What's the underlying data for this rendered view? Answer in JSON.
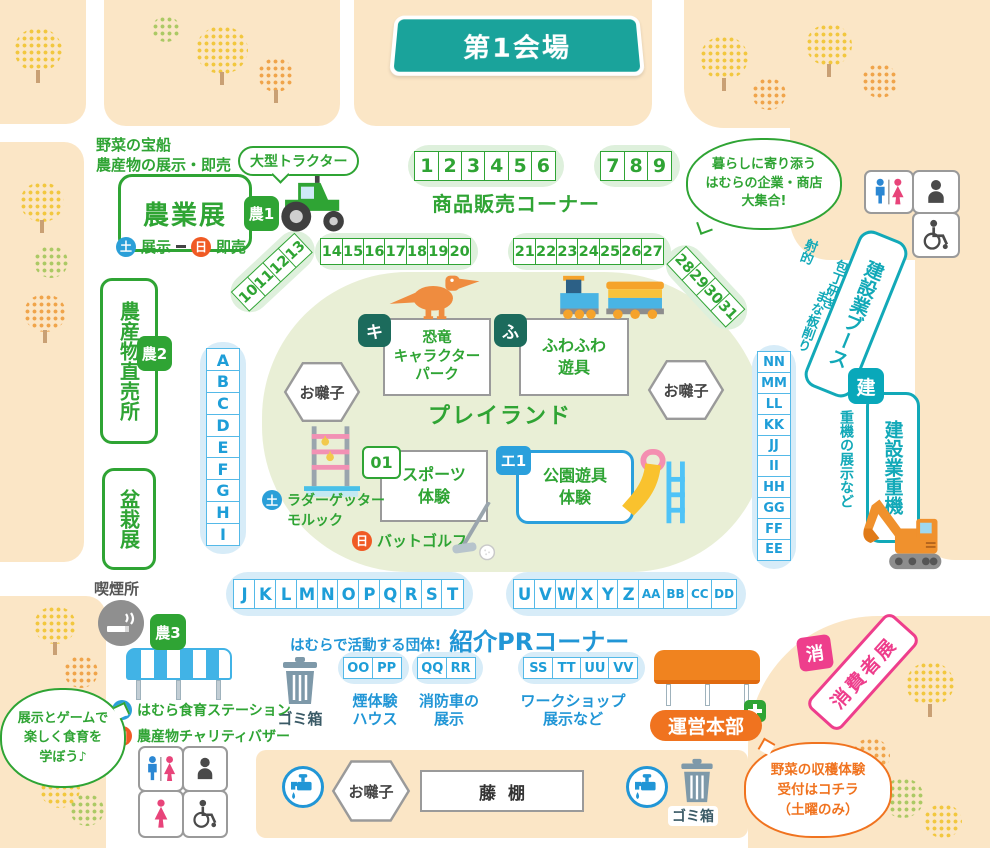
{
  "title": "第1会場",
  "agri": {
    "note_lines": [
      "野菜の宝船",
      "農産物の展示・即売"
    ],
    "bubble": "大型トラクター",
    "name": "農業展",
    "badge": "農1",
    "sat": "土",
    "sat_label": "展示",
    "sun": "日",
    "sun_label": "即売"
  },
  "sales": {
    "numbers1": [
      "1",
      "2",
      "3",
      "4",
      "5",
      "6"
    ],
    "numbers2": [
      "7",
      "8",
      "9"
    ],
    "label": "商品販売コーナー",
    "diag1": [
      "10",
      "11",
      "12",
      "13"
    ],
    "row1": [
      "14",
      "15",
      "16",
      "17",
      "18",
      "19",
      "20"
    ],
    "row2": [
      "21",
      "22",
      "23",
      "24",
      "25",
      "26",
      "27"
    ],
    "diag2": [
      "28",
      "29",
      "30",
      "31"
    ]
  },
  "bubble_companies": {
    "lines": [
      "暮らしに寄り添う",
      "はむらの企業・商店",
      "大集合!"
    ]
  },
  "left": {
    "farm_stand": "農産物直売所",
    "badge": "農2",
    "bonsai": "盆栽展",
    "letters": [
      "A",
      "B",
      "C",
      "D",
      "E",
      "F",
      "G",
      "H",
      "I"
    ],
    "smoking": "喫煙所"
  },
  "playland": {
    "label": "プレイランド",
    "ohayashi": "お囃子",
    "dino_badge": "キ",
    "dino_lines": [
      "恐竜",
      "キャラクター",
      "パーク"
    ],
    "fuwa_badge": "ふ",
    "fuwa_lines": [
      "ふわふわ",
      "遊具"
    ],
    "sports_badge": "01",
    "sports_lines": [
      "スポーツ",
      "体験"
    ],
    "sat": "土",
    "sat_lines": [
      "ラダーゲッター",
      "モルック"
    ],
    "sun": "日",
    "sun_label": "バットゴルフ",
    "park_badge": "エ1",
    "park_lines": [
      "公園遊具",
      "体験"
    ]
  },
  "right": {
    "letters": [
      "NN",
      "MM",
      "LL",
      "KK",
      "JJ",
      "II",
      "HH",
      "GG",
      "FF",
      "EE"
    ],
    "act1": "射的",
    "act2": "包丁研ぎ",
    "act3": "まな板削り",
    "booth": "建設業ブース",
    "badge": "建",
    "heavy": "建設業重機",
    "heavy_note": "重機の展示など"
  },
  "letters_row1": [
    "J",
    "K",
    "L",
    "M",
    "N",
    "O",
    "P",
    "Q",
    "R",
    "S",
    "T"
  ],
  "letters_row2": [
    "U",
    "V",
    "W",
    "X",
    "Y",
    "Z",
    "AA",
    "BB",
    "CC",
    "DD"
  ],
  "pr": {
    "intro": "はむらで活動する団体!",
    "title": "紹介PRコーナー",
    "trash": "ゴミ箱",
    "groups": [
      {
        "letters": [
          "OO",
          "PP"
        ],
        "lines": [
          "煙体験",
          "ハウス"
        ]
      },
      {
        "letters": [
          "QQ",
          "RR"
        ],
        "lines": [
          "消防車の",
          "展示"
        ]
      },
      {
        "letters": [
          "SS",
          "TT",
          "UU",
          "VV"
        ],
        "lines": [
          "ワークショップ",
          "展示など"
        ]
      }
    ]
  },
  "agri3": {
    "badge": "農3",
    "sat": "土",
    "sat_label": "はむら食育ステーション",
    "sun": "日",
    "sun_label": "農産物チャリティバザー",
    "bubble_lines": [
      "展示とゲームで",
      "楽しく食育を",
      "学ぼう♪"
    ]
  },
  "hq": {
    "label": "運営本部",
    "sho_badge": "消",
    "consumer": "消費者展",
    "bubble_lines": [
      "野菜の収穫体験",
      "受付はコチラ",
      "（土曜のみ）"
    ]
  },
  "strip": {
    "ohayashi": "お囃子",
    "fuji": "藤棚",
    "trash": "ゴミ箱"
  },
  "colors": {
    "teal_banner": "#1aa39b",
    "green": "#2fa434",
    "blue": "#2196d6",
    "cyan": "#12a9b8",
    "orange": "#f0731f",
    "pink": "#ee3e8c",
    "sat_blue": "#2b9fd8",
    "sun_orange": "#f05a24",
    "dark_badge": "#1c6b5c"
  }
}
